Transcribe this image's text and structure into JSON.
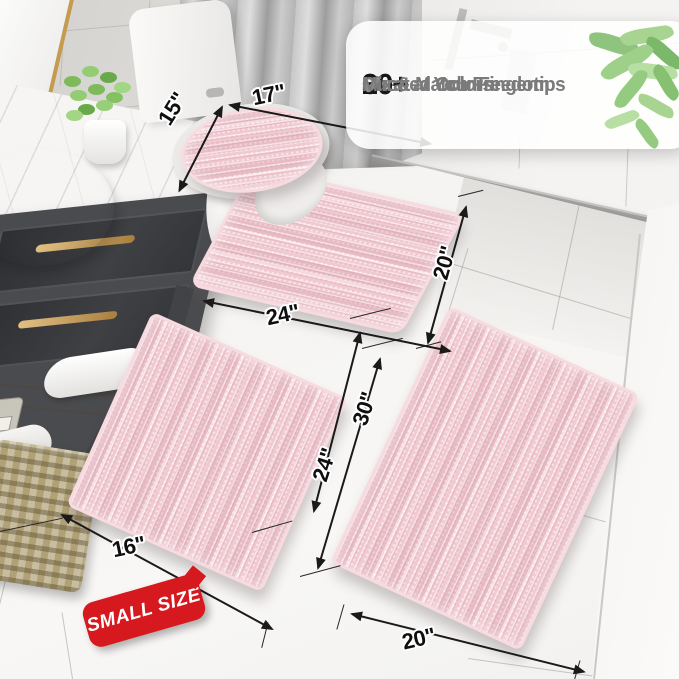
{
  "callout": {
    "items": [
      {
        "check": "✔",
        "stat": "20+",
        "label": "Sizes at Your Fingertips"
      },
      {
        "check": "✔",
        "stat": "30+",
        "label": "Curated Colors"
      },
      {
        "check": "✔",
        "stat": "",
        "label": "Mix & Match Freedom"
      }
    ]
  },
  "dimensions": {
    "lid_depth": "15\"",
    "lid_width": "17\"",
    "contour_width": "24\"",
    "contour_height": "20\"",
    "small_rug_width": "16\"",
    "small_rug_length": "24\"",
    "large_rug_length": "30\"",
    "large_rug_width": "20\""
  },
  "badge": {
    "label": "SMALL SIZE"
  },
  "colors": {
    "rug_pink": "#f0c9d1",
    "badge_red": "#d6191f",
    "gold_accent": "#c59b4e",
    "vanity_charcoal": "#4a4b4e",
    "stat_text": "#161616",
    "feature_text": "#7b7b7b",
    "check_gray": "#8c8c8c",
    "plant_green": "#8fc47e"
  }
}
